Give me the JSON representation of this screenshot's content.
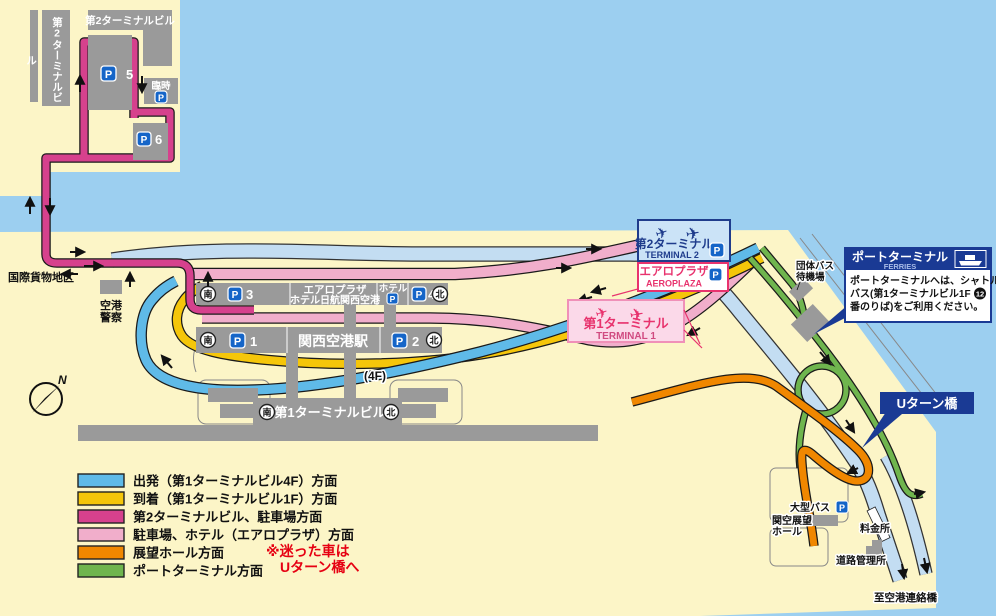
{
  "colors": {
    "water": "#9CCFF0",
    "land": "#FCF5C7",
    "building": "#9A9A9A",
    "route_departure_blue": "#5FBAE8",
    "route_arrival_yellow": "#F5C60A",
    "route_terminal2_magenta": "#D6418D",
    "route_parking_pink": "#F1AECB",
    "route_observation_orange": "#F08700",
    "route_port_green": "#6FB54E",
    "highway": "#C3DDF2",
    "navy": "#1A3A94",
    "accent_red": "#E60012",
    "pink_accent": "#E8336E"
  },
  "icons": {
    "p": "P",
    "plane": "✈"
  },
  "terminal2_area": {
    "building_top": "第2ターミナルビル",
    "building_side": "第2ターミナルビル",
    "temporary": "臨時",
    "p5": "5",
    "p6": "6"
  },
  "map_labels": {
    "intl_cargo": "国際貨物地区",
    "police_line1": "空港",
    "police_line2": "警察",
    "p1": "1",
    "p2": "2",
    "p3": "3",
    "p4": "4",
    "aeroplaza_hotel_line1": "エアロプラザ",
    "aeroplaza_hotel_line2": "ホテル日航関西空港",
    "hotel": "ホテル",
    "station": "関西空港駅",
    "terminal1_building": "第1ターミナルビル",
    "floor_4f": "(4F)",
    "south": "南",
    "north": "北",
    "group_bus_line1": "団体バス",
    "group_bus_line2": "待機場",
    "large_bus": "大型バス",
    "observation_line1": "関空展望",
    "observation_line2": "ホール",
    "toll_gate": "料金所",
    "road_office": "道路管理所",
    "to_bridge": "至空港連絡橋"
  },
  "label_boxes": {
    "terminal2": {
      "jp": "第2ターミナル",
      "en": "TERMINAL 2"
    },
    "aeroplaza": {
      "jp": "エアロプラザ",
      "en": "AEROPLAZA"
    },
    "terminal1": {
      "jp": "第1ターミナル",
      "en": "TERMINAL 1"
    },
    "ferries": {
      "title": "ポートターミナル",
      "en": "FERRIES",
      "body_line1": "ポートターミナルへは、シャトル",
      "body_line2": "バス(第1ターミナルビル1F",
      "badge": "12",
      "body_line3": "番のりば)をご利用ください。"
    },
    "uturn": "Uターン橋"
  },
  "legend": {
    "items": [
      {
        "label": "出発（第1ターミナルビル4F）方面",
        "color": "#5FBAE8"
      },
      {
        "label": "到着（第1ターミナルビル1F）方面",
        "color": "#F5C60A"
      },
      {
        "label": "第2ターミナルビル、駐車場方面",
        "color": "#D6418D"
      },
      {
        "label": "駐車場、ホテル（エアロプラザ）方面",
        "color": "#F1AECB"
      },
      {
        "label": "展望ホール方面",
        "color": "#F08700"
      },
      {
        "label": "ポートターミナル方面",
        "color": "#6FB54E"
      }
    ],
    "note_line1": "※迷った車は",
    "note_line2": "Uターン橋へ"
  },
  "compass": {
    "n": "N"
  }
}
